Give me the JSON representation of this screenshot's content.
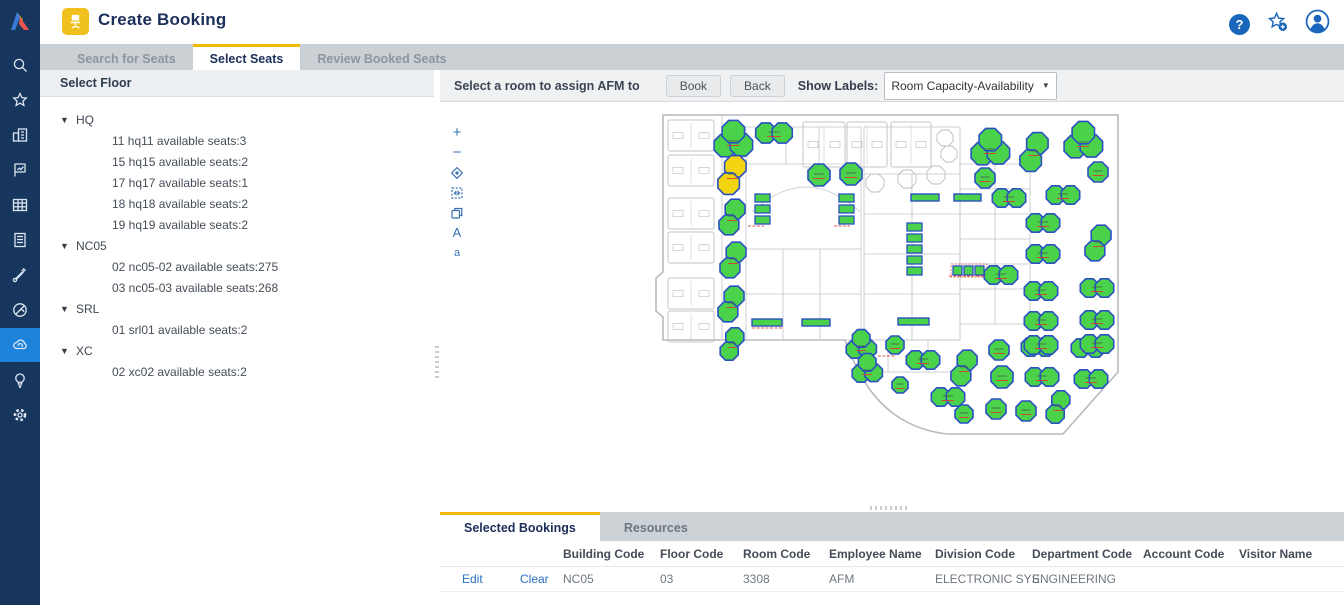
{
  "app": {
    "title": "Create Booking"
  },
  "header": {
    "help": "?"
  },
  "sidebar": {
    "items": [
      "search",
      "favorites",
      "buildings",
      "report-flag",
      "space-grid",
      "documents",
      "tools",
      "sustainability",
      "workplace-cloud",
      "ideas",
      "settings"
    ],
    "active_index": 8
  },
  "nav_tabs": [
    {
      "label": "Search for Seats",
      "active": false
    },
    {
      "label": "Select Seats",
      "active": true
    },
    {
      "label": "Review Booked Seats",
      "active": false
    }
  ],
  "floor_panel": {
    "title": "Select Floor",
    "tree": [
      {
        "label": "HQ",
        "children": [
          "11 hq11 available seats:3",
          "15 hq15 available seats:2",
          "17 hq17 available seats:1",
          "18 hq18 available seats:2",
          "19 hq19 available seats:2"
        ]
      },
      {
        "label": "NC05",
        "children": [
          "02 nc05-02 available seats:275",
          "03 nc05-03 available seats:268"
        ]
      },
      {
        "label": "SRL",
        "children": [
          "01 srl01 available seats:2"
        ]
      },
      {
        "label": "XC",
        "children": [
          "02 xc02 available seats:2"
        ]
      }
    ]
  },
  "map_panel": {
    "instruction": "Select a room to assign AFM to",
    "book_label": "Book",
    "back_label": "Back",
    "show_labels_label": "Show Labels:",
    "show_labels_value": "Room Capacity-Availability",
    "tools": {
      "text_large": "A",
      "text_small": "a"
    }
  },
  "bottom_panel": {
    "tabs": [
      {
        "label": "Selected Bookings",
        "active": true
      },
      {
        "label": "Resources",
        "active": false
      }
    ],
    "columns": [
      "Building Code",
      "Floor Code",
      "Room Code",
      "Employee Name",
      "Division Code",
      "Department Code",
      "Account Code",
      "Visitor Name"
    ],
    "row": {
      "edit_label": "Edit",
      "clear_label": "Clear",
      "values": [
        "NC05",
        "03",
        "3308",
        "AFM",
        "ELECTRONIC SYS.",
        "ENGINEERING",
        "",
        ""
      ]
    }
  },
  "colors": {
    "accent_yellow": "#f0b800",
    "navy_text": "#1c2f5a",
    "sidebar_bg": "#17365e",
    "sidebar_active_bg": "#1d83da",
    "link_blue": "#2a6fc0",
    "room_available_green": "#4ad34a",
    "room_selected_yellow": "#f2d411",
    "room_border_blue": "#2a50c2",
    "availability_red": "#e03a2f",
    "wall_gray": "#b6babe"
  },
  "floor_map": {
    "rooms": [
      {
        "k": "tri",
        "x": 85,
        "y": 36,
        "r": 14
      },
      {
        "k": "peanut",
        "x": 126,
        "y": 29,
        "r": 11
      },
      {
        "k": "v2",
        "x": 84,
        "y": 71,
        "r": 12,
        "c": "y"
      },
      {
        "k": "v2",
        "x": 84,
        "y": 113,
        "r": 11
      },
      {
        "k": "v2",
        "x": 85,
        "y": 156,
        "r": 11
      },
      {
        "k": "v2",
        "x": 83,
        "y": 200,
        "r": 11
      },
      {
        "k": "v2",
        "x": 84,
        "y": 240,
        "r": 10
      },
      {
        "k": "hex",
        "x": 171,
        "y": 71,
        "r": 11
      },
      {
        "k": "hex",
        "x": 203,
        "y": 70,
        "r": 11
      },
      {
        "k": "vstack",
        "x": 107,
        "y": 90,
        "n": 3
      },
      {
        "k": "vstack",
        "x": 191,
        "y": 90,
        "n": 3
      },
      {
        "k": "vstack",
        "x": 259,
        "y": 119,
        "n": 5
      },
      {
        "k": "hbar",
        "x": 263,
        "y": 90,
        "w": 28,
        "h": 7
      },
      {
        "k": "hbar",
        "x": 306,
        "y": 90,
        "w": 27,
        "h": 7
      },
      {
        "k": "trio",
        "x": 305,
        "y": 162
      },
      {
        "k": "hbar",
        "x": 104,
        "y": 215,
        "w": 30,
        "h": 7
      },
      {
        "k": "hbar",
        "x": 154,
        "y": 215,
        "w": 28,
        "h": 7
      },
      {
        "k": "hbar",
        "x": 250,
        "y": 214,
        "w": 31,
        "h": 7
      },
      {
        "k": "tri",
        "x": 213,
        "y": 241,
        "r": 11
      },
      {
        "k": "hex",
        "x": 247,
        "y": 241,
        "r": 9
      },
      {
        "k": "tri",
        "x": 219,
        "y": 265,
        "r": 11
      },
      {
        "k": "hex",
        "x": 252,
        "y": 281,
        "r": 8
      },
      {
        "k": "peanut",
        "x": 275,
        "y": 256,
        "r": 10
      },
      {
        "k": "v2",
        "x": 316,
        "y": 264,
        "r": 11
      },
      {
        "k": "hex",
        "x": 351,
        "y": 246,
        "r": 10
      },
      {
        "k": "peanut",
        "x": 390,
        "y": 243,
        "r": 10
      },
      {
        "k": "peanut",
        "x": 440,
        "y": 244,
        "r": 10
      },
      {
        "k": "hex",
        "x": 354,
        "y": 273,
        "r": 11
      },
      {
        "k": "peanut",
        "x": 394,
        "y": 273,
        "r": 10
      },
      {
        "k": "peanut",
        "x": 443,
        "y": 275,
        "r": 10
      },
      {
        "k": "peanut",
        "x": 300,
        "y": 293,
        "r": 10
      },
      {
        "k": "hex",
        "x": 316,
        "y": 310,
        "r": 9
      },
      {
        "k": "hex",
        "x": 348,
        "y": 305,
        "r": 10
      },
      {
        "k": "hex",
        "x": 378,
        "y": 307,
        "r": 10
      },
      {
        "k": "v2",
        "x": 410,
        "y": 303,
        "r": 10
      },
      {
        "k": "tri",
        "x": 342,
        "y": 44,
        "r": 14
      },
      {
        "k": "v2",
        "x": 386,
        "y": 48,
        "r": 12
      },
      {
        "k": "tri",
        "x": 435,
        "y": 37,
        "r": 14
      },
      {
        "k": "hex",
        "x": 450,
        "y": 68,
        "r": 10
      },
      {
        "k": "hex",
        "x": 337,
        "y": 74,
        "r": 10
      },
      {
        "k": "peanut",
        "x": 361,
        "y": 94,
        "r": 10
      },
      {
        "k": "peanut",
        "x": 415,
        "y": 91,
        "r": 10
      },
      {
        "k": "peanut",
        "x": 395,
        "y": 119,
        "r": 10
      },
      {
        "k": "v2",
        "x": 450,
        "y": 139,
        "r": 11
      },
      {
        "k": "peanut",
        "x": 395,
        "y": 150,
        "r": 10
      },
      {
        "k": "peanut",
        "x": 353,
        "y": 171,
        "r": 10
      },
      {
        "k": "peanut",
        "x": 393,
        "y": 187,
        "r": 10
      },
      {
        "k": "peanut",
        "x": 449,
        "y": 184,
        "r": 10
      },
      {
        "k": "peanut",
        "x": 393,
        "y": 217,
        "r": 10
      },
      {
        "k": "peanut",
        "x": 449,
        "y": 216,
        "r": 10
      },
      {
        "k": "peanut",
        "x": 393,
        "y": 241,
        "r": 10
      },
      {
        "k": "peanut",
        "x": 449,
        "y": 240,
        "r": 10
      }
    ],
    "cubicles": [
      {
        "x": 20,
        "y": 16,
        "w": 46,
        "h": 31
      },
      {
        "x": 20,
        "y": 51,
        "w": 46,
        "h": 31
      },
      {
        "x": 20,
        "y": 94,
        "w": 46,
        "h": 31
      },
      {
        "x": 20,
        "y": 128,
        "w": 46,
        "h": 31
      },
      {
        "x": 20,
        "y": 174,
        "w": 46,
        "h": 31
      },
      {
        "x": 20,
        "y": 207,
        "w": 46,
        "h": 31
      },
      {
        "x": 155,
        "y": 18,
        "w": 42,
        "h": 45
      },
      {
        "x": 199,
        "y": 18,
        "w": 40,
        "h": 45
      },
      {
        "x": 243,
        "y": 18,
        "w": 40,
        "h": 45
      }
    ],
    "gray_hexes": [
      [
        227,
        79,
        9
      ],
      [
        259,
        75,
        9
      ],
      [
        288,
        71,
        9
      ],
      [
        297,
        34,
        8
      ],
      [
        301,
        50,
        8
      ]
    ],
    "red_dashes": [
      [
        301,
        172,
        36
      ],
      [
        100,
        122,
        16
      ],
      [
        186,
        122,
        16
      ],
      [
        230,
        252,
        18
      ],
      [
        104,
        224,
        30
      ]
    ]
  }
}
